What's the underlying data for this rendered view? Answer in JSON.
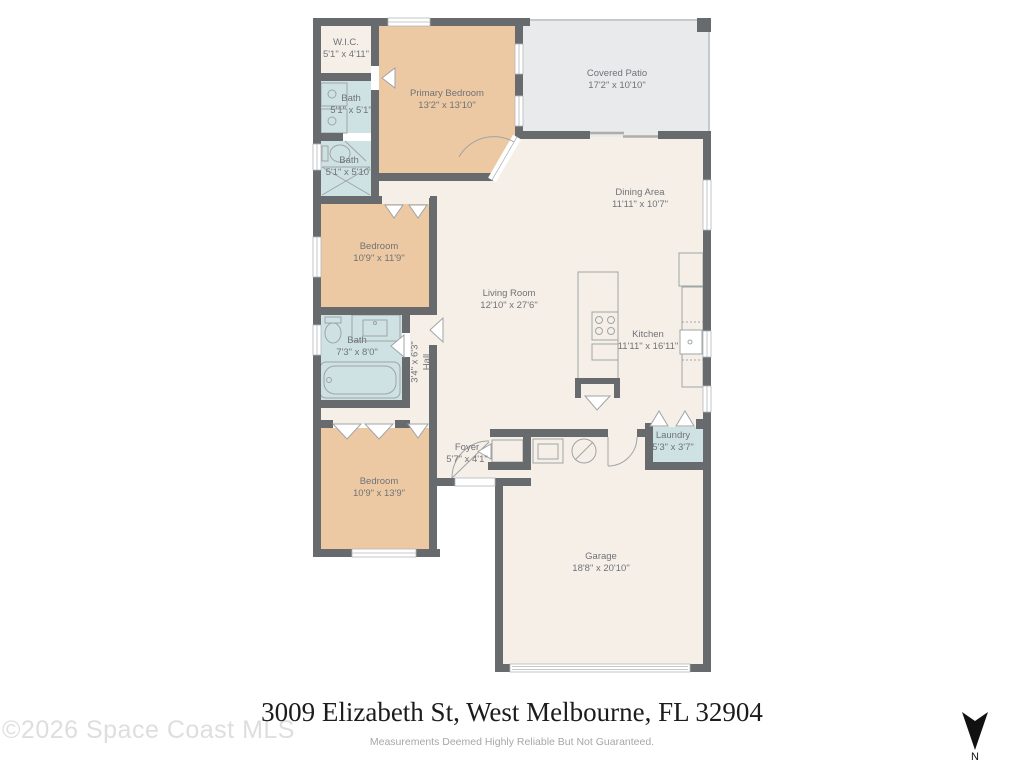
{
  "rooms": {
    "wic": {
      "name": "W.I.C.",
      "dims": "5'1\" x 4'11\""
    },
    "bath1": {
      "name": "Bath",
      "dims": "5'1\" x 5'1\""
    },
    "bath2": {
      "name": "Bath",
      "dims": "5'1\" x 5'10\""
    },
    "primary_bedroom": {
      "name": "Primary Bedroom",
      "dims": "13'2\" x 13'10\""
    },
    "covered_patio": {
      "name": "Covered Patio",
      "dims": "17'2\" x 10'10\""
    },
    "dining": {
      "name": "Dining Area",
      "dims": "11'11\" x 10'7\""
    },
    "living": {
      "name": "Living Room",
      "dims": "12'10\" x 27'6\""
    },
    "kitchen": {
      "name": "Kitchen",
      "dims": "11'11\" x 16'11\""
    },
    "bedroom2": {
      "name": "Bedroom",
      "dims": "10'9\" x 11'9\""
    },
    "bath3": {
      "name": "Bath",
      "dims": "7'3\" x 8'0\""
    },
    "hall": {
      "name": "Hall",
      "dims": "3'4\" x 6'3\""
    },
    "bedroom3": {
      "name": "Bedroom",
      "dims": "10'9\" x 13'9\""
    },
    "foyer": {
      "name": "Foyer",
      "dims": "5'7\" x 4'1\""
    },
    "laundry": {
      "name": "Laundry",
      "dims": "5'3\" x 3'7\""
    },
    "garage": {
      "name": "Garage",
      "dims": "18'8\" x 20'10\""
    }
  },
  "footer": {
    "address": "3009 Elizabeth St, West Melbourne, FL 32904",
    "disclaimer": "Measurements Deemed Highly Reliable But Not Guaranteed.",
    "watermark": "©2026 Space Coast MLS",
    "compass_label": "N"
  },
  "palette": {
    "wall": "#686b6e",
    "floor_cream": "#f6efe8",
    "bedroom_tan": "#edc9a3",
    "bath_blue": "#cfe2e3",
    "patio_gray": "#e9eaeb",
    "label_text": "#6f7377"
  }
}
